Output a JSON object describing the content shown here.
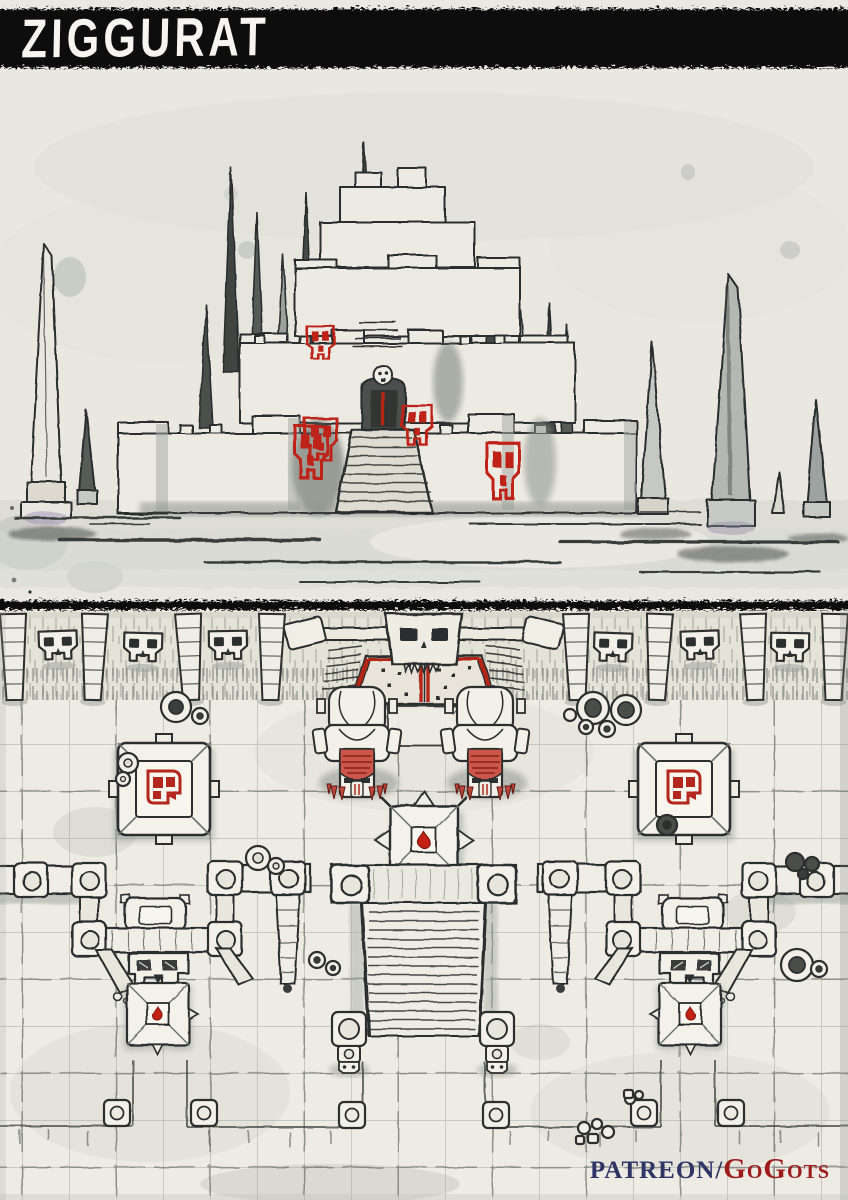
{
  "title_bar": {
    "title": "ZIGGURAT"
  },
  "credit": {
    "site": "PATREON/",
    "author": "GoGots"
  },
  "palette": {
    "paper": "#eae8e1",
    "ink": "#2e312f",
    "accent_red": "#bf2719",
    "statue_red": "#cd564a",
    "credit_navy": "#2e3566",
    "credit_red": "#9e1b1b",
    "band_black": "#0f0f0d"
  },
  "panels": {
    "illustration": {
      "name": "ziggurat-exterior-sketch",
      "features": [
        "stepped-ziggurat",
        "skull-banner",
        "entrance-arch-with-skull",
        "grand-staircase",
        "tower-spike",
        "obelisk",
        "ink-wash-ground"
      ]
    },
    "map": {
      "name": "ziggurat-interior-battle-map",
      "features": [
        "grid-floor",
        "north-wall",
        "skull-relief",
        "tapered-pillar",
        "skull-gate",
        "guardian-statue",
        "skull-altar",
        "spiked-blood-pedestal",
        "side-shrine",
        "blood-drop-pedestal",
        "grand-staircase",
        "guardian-post",
        "rubble-stones",
        "floor-marker"
      ]
    }
  }
}
